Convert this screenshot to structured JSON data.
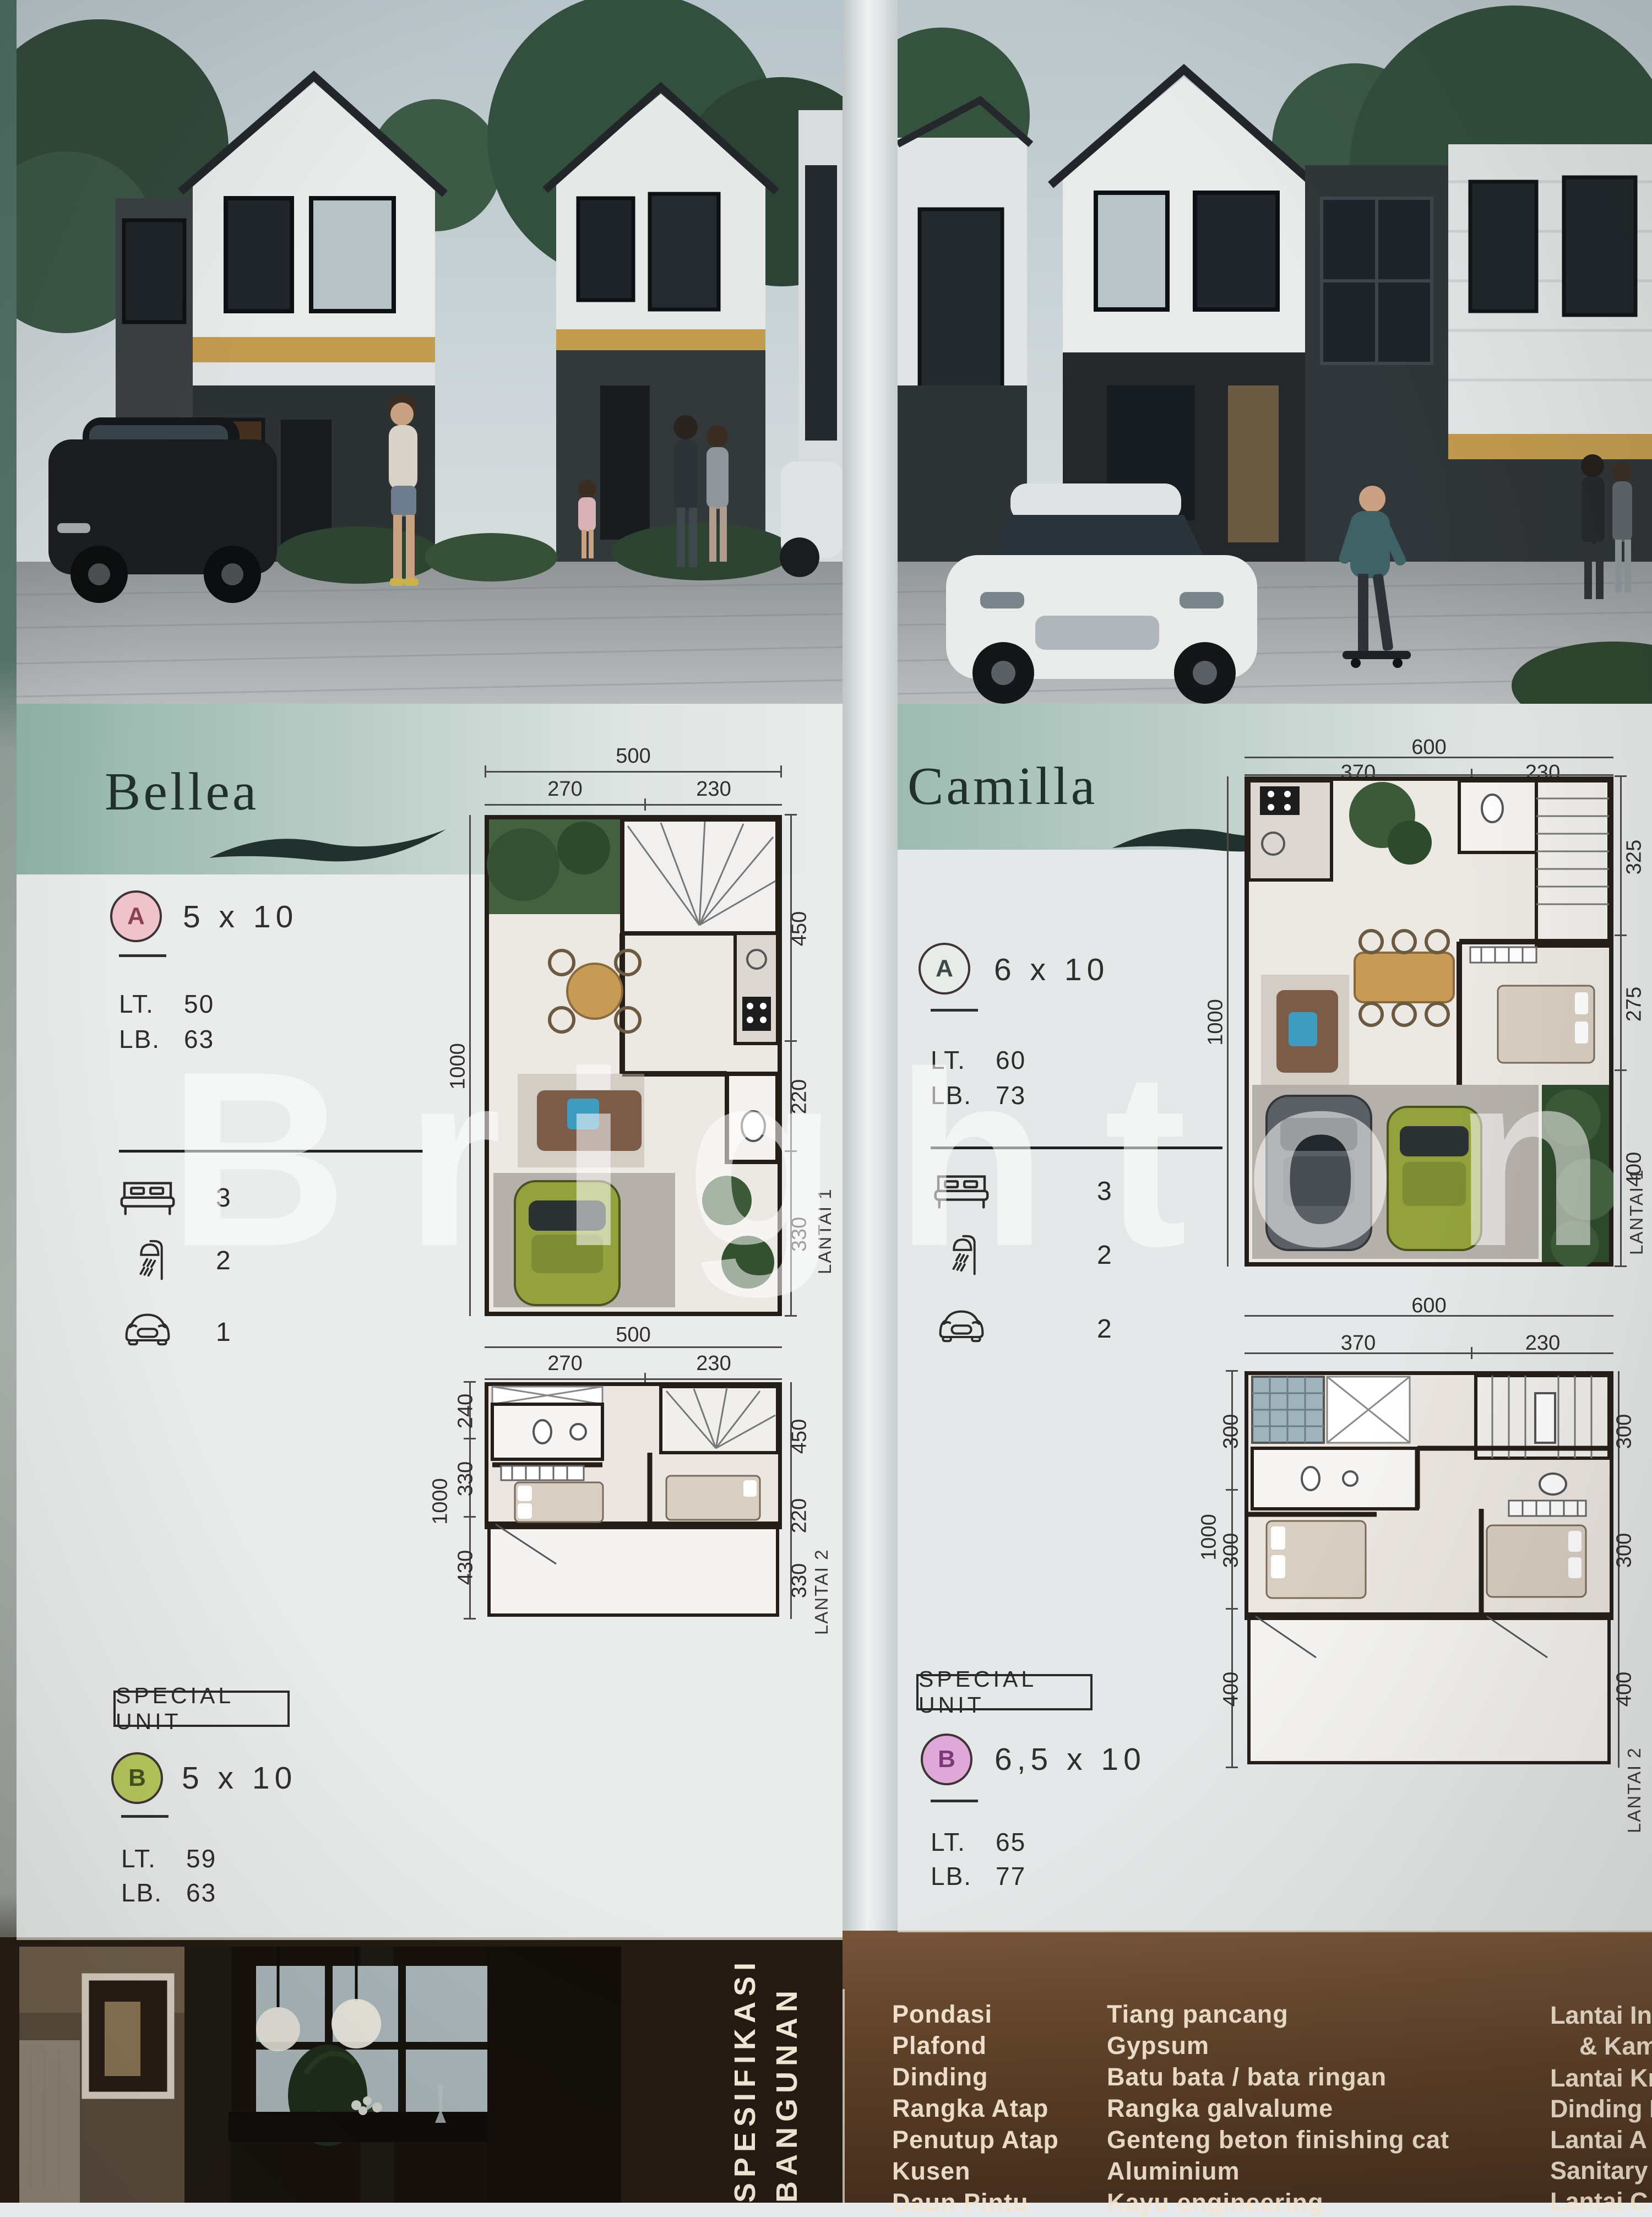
{
  "watermark": "Brighton",
  "bellea": {
    "title": "Bellea",
    "unit_a": {
      "badge": "A",
      "size": "5 x 10",
      "lt_label": "LT.",
      "lt_value": "50",
      "lb_label": "LB.",
      "lb_value": "63"
    },
    "features": {
      "beds": "3",
      "baths": "2",
      "cars": "1"
    },
    "special_unit_label": "SPECIAL UNIT",
    "unit_b": {
      "badge": "B",
      "size": "5 x 10",
      "lt_label": "LT.",
      "lt_value": "59",
      "lb_label": "LB.",
      "lb_value": "63"
    },
    "plan1": {
      "floor": "LANTAI 1",
      "total": "500",
      "segA": "270",
      "segB": "230",
      "left": "1000",
      "right": [
        "450",
        "220",
        "330"
      ]
    },
    "plan2": {
      "floor": "LANTAI 2",
      "total": "500",
      "segA": "270",
      "segB": "230",
      "left": [
        "240",
        "330",
        "1000",
        "430"
      ],
      "right": [
        "450",
        "220",
        "330"
      ]
    }
  },
  "camilla": {
    "title": "Camilla",
    "unit_a": {
      "badge": "A",
      "size": "6 x 10",
      "lt_label": "LT.",
      "lt_value": "60",
      "lb_label": "LB.",
      "lb_value": "73"
    },
    "features": {
      "beds": "3",
      "baths": "2",
      "cars": "2"
    },
    "special_unit_label": "SPECIAL UNIT",
    "unit_b": {
      "badge": "B",
      "size": "6,5 x 10",
      "lt_label": "LT.",
      "lt_value": "65",
      "lb_label": "LB.",
      "lb_value": "77"
    },
    "plan1": {
      "floor": "LANTAI 1",
      "total": "600",
      "segA": "370",
      "segB": "230",
      "left": "1000",
      "right": [
        "325",
        "275",
        "400"
      ]
    },
    "plan2": {
      "floor": "LANTAI 2",
      "total": "600",
      "segA": "370",
      "segB": "230",
      "left": [
        "300",
        "300",
        "1000",
        "400"
      ],
      "right": [
        "300",
        "300",
        "400"
      ]
    }
  },
  "spec": {
    "header_line1": "SPESIFIKASI",
    "header_line2": "BANGUNAN",
    "rows": [
      {
        "label": "Pondasi",
        "value": "Tiang pancang"
      },
      {
        "label": "Plafond",
        "value": "Gypsum"
      },
      {
        "label": "Dinding",
        "value": "Batu bata / bata ringan"
      },
      {
        "label": "Rangka Atap",
        "value": "Rangka galvalume"
      },
      {
        "label": "Penutup Atap",
        "value": "Genteng beton finishing cat"
      },
      {
        "label": "Kusen",
        "value": "Aluminium"
      },
      {
        "label": "Daun Pintu",
        "value": "Kayu engineering"
      }
    ],
    "right_column_truncated": [
      "Lantai In",
      "& Kam",
      "Lantai Kr",
      "Dinding K",
      "Lantai A",
      "Sanitary",
      "Lantai C"
    ]
  },
  "colors": {
    "band_teal": "#8fb3a8",
    "badge_pink": "#eec3cb",
    "badge_green": "#b6c95c",
    "badge_purple": "#dfa8d8",
    "panel_brown": "#6b4a30",
    "accent_yellow": "#c29b4f"
  }
}
